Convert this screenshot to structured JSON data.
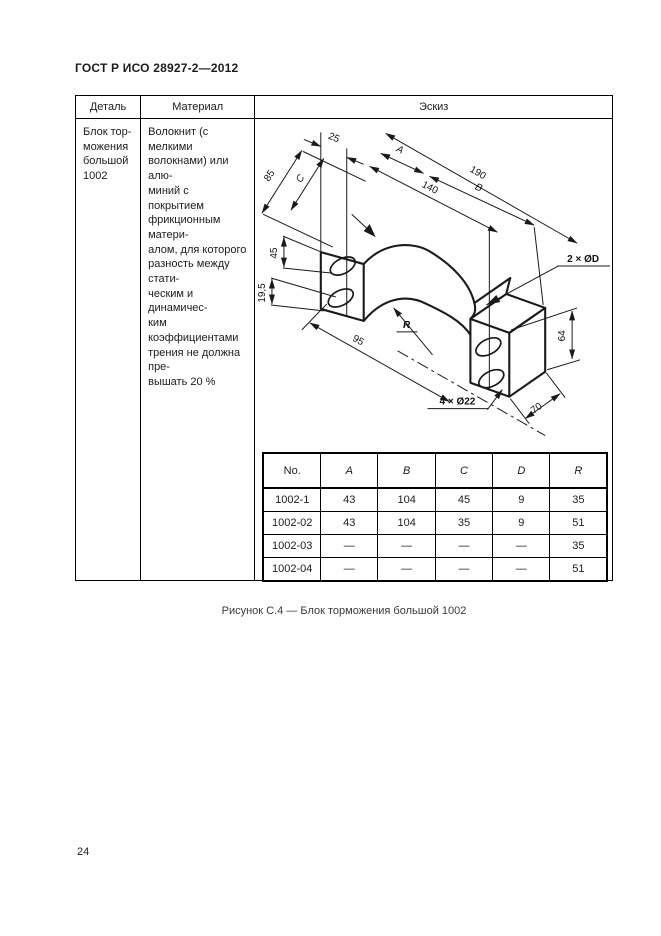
{
  "page": {
    "header": "ГОСТ Р ИСО 28927-2—2012",
    "page_number": "24",
    "caption": "Рисунок С.4 — Блок торможения большой 1002"
  },
  "table": {
    "headers": {
      "detail": "Деталь",
      "material": "Материал",
      "sketch": "Эскиз"
    },
    "row": {
      "detail": "Блок тор-\nможения\nбольшой\n1002",
      "material": "Волокнит (с мелкими\nволокнами) или алю-\nминий с покрытием\nфрикционным матери-\nалом, для которого\nразность между стати-\nческим и динамичес-\nким коэффициентами\nтрения не должна пре-\nвышать 20 %"
    }
  },
  "drawing": {
    "labels": {
      "d25": "25",
      "d85": "85",
      "dC": "C",
      "dA": "A",
      "d140": "140",
      "dB": "B",
      "d190": "190",
      "d45": "45",
      "d19_5": "19,5",
      "d95": "95",
      "dR": "R",
      "holes4": "4 × Ø22",
      "holes2": "2 × ØD",
      "d64": "64",
      "d70": "70"
    }
  },
  "dim_table": {
    "columns": [
      "No.",
      "A",
      "B",
      "C",
      "D",
      "R"
    ],
    "rows": [
      [
        "1002-1",
        "43",
        "104",
        "45",
        "9",
        "35"
      ],
      [
        "1002-02",
        "43",
        "104",
        "35",
        "9",
        "51"
      ],
      [
        "1002-03",
        "—",
        "—",
        "—",
        "—",
        "35"
      ],
      [
        "1002-04",
        "—",
        "—",
        "—",
        "—",
        "51"
      ]
    ]
  }
}
